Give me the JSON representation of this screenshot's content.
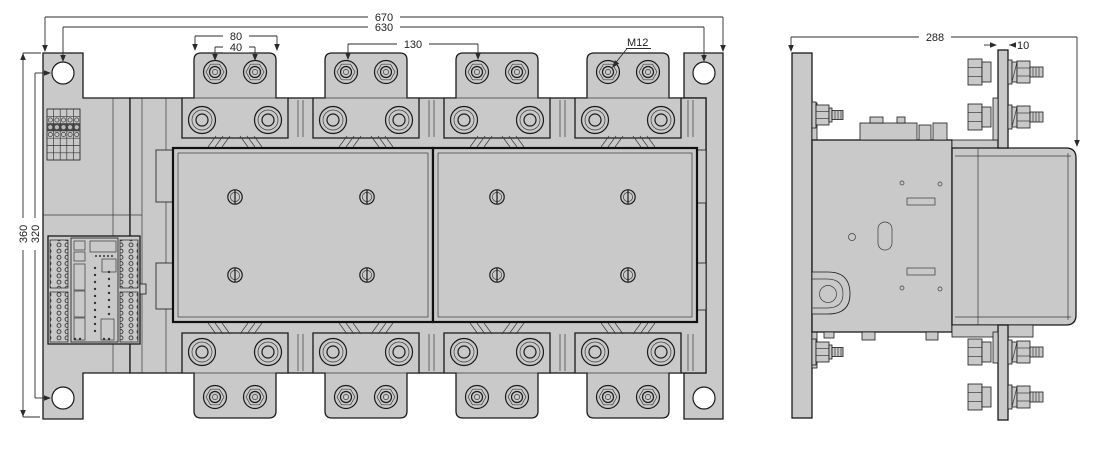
{
  "drawing": {
    "type": "technical-dimension-drawing",
    "subject": "4-pole power contactor, front and side views"
  },
  "front_view": {
    "dim_total_width": "670",
    "dim_fixing_hole_spacing_width": "630",
    "dim_terminal_pad_width": "80",
    "dim_terminal_hole_spacing": "40",
    "dim_pole_pitch": "130",
    "terminal_thread": "M12",
    "dim_total_height": "360",
    "dim_fixing_hole_spacing_height": "320"
  },
  "side_view": {
    "dim_total_depth": "288",
    "dim_busbar_thickness": "10"
  },
  "colors": {
    "part_fill": "#c9c9c9",
    "outline": "#1a1a1a",
    "dimension_line": "#2b2b2b",
    "text": "#222222",
    "background": "#ffffff"
  }
}
